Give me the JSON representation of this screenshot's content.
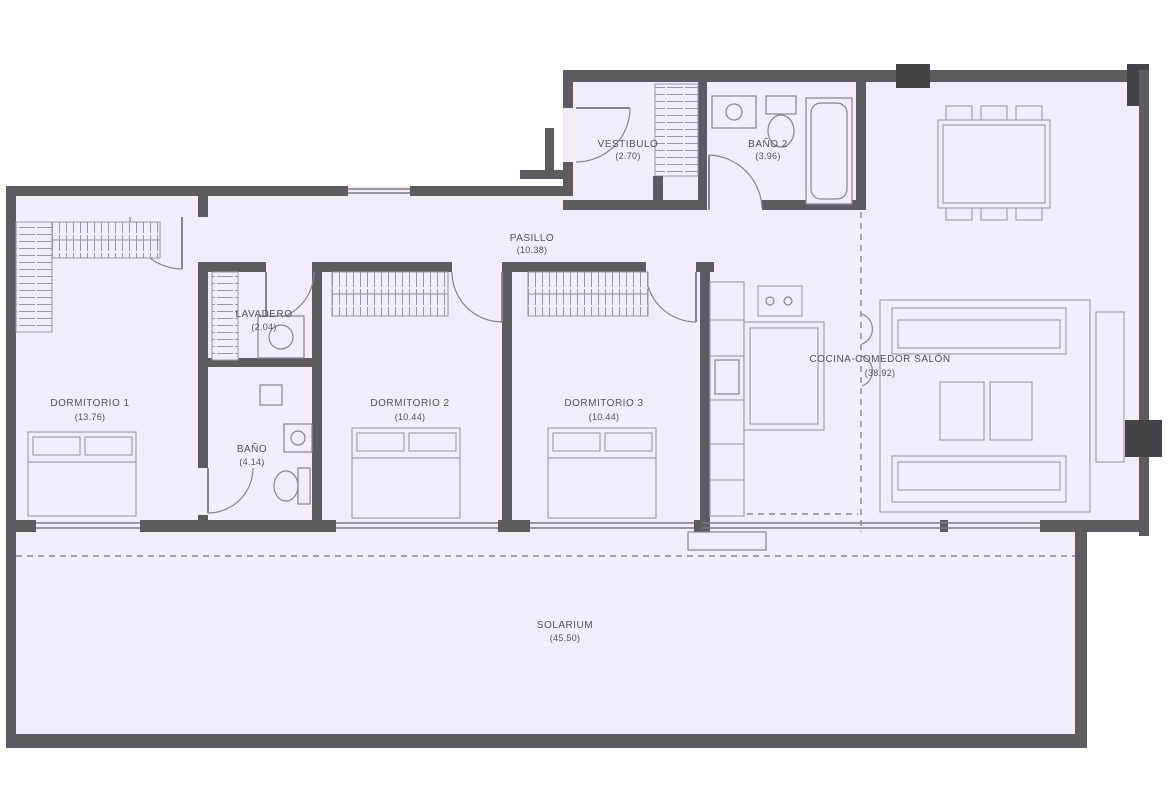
{
  "title": "Apartment floor plan",
  "rooms": {
    "dormitorio1": {
      "label": "DORMITORIO 1",
      "area": "(13.76)"
    },
    "dormitorio2": {
      "label": "DORMITORIO 2",
      "area": "(10.44)"
    },
    "dormitorio3": {
      "label": "DORMITORIO 3",
      "area": "(10.44)"
    },
    "bano": {
      "label": "BAÑO",
      "area": "(4.14)"
    },
    "bano2": {
      "label": "BAÑO 2",
      "area": "(3.96)"
    },
    "lavadero": {
      "label": "LAVADERO",
      "area": "(2.04)"
    },
    "vestibulo": {
      "label": "VESTIBULO",
      "area": "(2.70)"
    },
    "pasillo": {
      "label": "PASILLO",
      "area": "(10.38)"
    },
    "salon": {
      "label": "COCINA-COMEDOR SALÓN",
      "area": "(38.92)"
    },
    "solarium": {
      "label": "SOLARIUM",
      "area": "(45.50)"
    }
  },
  "colors": {
    "floor": "#f4edf7",
    "wall": "#5d5a62",
    "wall_dark": "#45424a",
    "line": "#a79db2",
    "line2": "#8a8292",
    "win": "#7d7887",
    "dash": "#8d8496",
    "hatch": "#9d93a8",
    "ink": "#55505c"
  }
}
